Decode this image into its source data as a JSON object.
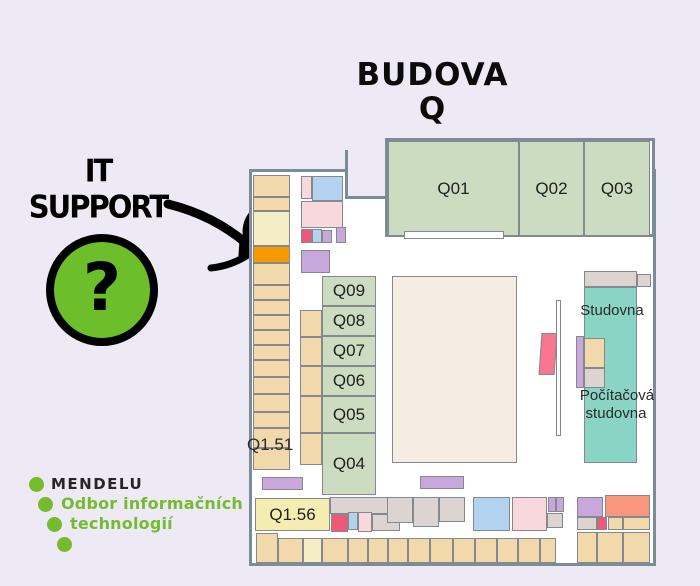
{
  "background": "#EDEAF6",
  "title": {
    "line1": "BUDOVA",
    "line2": "Q"
  },
  "callout": {
    "line1": "IT",
    "line2": "SUPPORT"
  },
  "badge": {
    "symbol": "?",
    "fill": "#6CBE2B"
  },
  "logo": {
    "brand": "MENDELU",
    "dept_line1": "Odbor informačních",
    "dept_line2": "technologií",
    "green": "#74BB2D",
    "brand_color": "#262626"
  },
  "map": {
    "outline_color": "#7c8b95",
    "room_border": "#85898e",
    "colors": {
      "tan": "#F1D9AB",
      "cream": "#F3EEC5",
      "yellow": "#F5ECB2",
      "orange": "#F79A02",
      "green": "#CBDCC1",
      "beige": "#F5EDE1",
      "teal": "#8AD4C6",
      "purple": "#C8A7DD",
      "blue": "#B3D2F0",
      "pink": "#F8D7DD",
      "red": "#EF5878",
      "magenta": "#F8768F",
      "salmon": "#F8977B",
      "gray": "#DBD4D1",
      "white": "#FFFFFF"
    },
    "rooms": [
      {
        "x": 388,
        "y": 141,
        "w": 131,
        "h": 95,
        "c": "green",
        "t": "Q01",
        "i": "room-q01"
      },
      {
        "x": 519,
        "y": 141,
        "w": 65,
        "h": 95,
        "c": "green",
        "t": "Q02",
        "i": "room-q02"
      },
      {
        "x": 584,
        "y": 141,
        "w": 66,
        "h": 95,
        "c": "green",
        "t": "Q03",
        "i": "room-q03"
      },
      {
        "x": 404,
        "y": 231,
        "w": 100,
        "h": 8,
        "c": "white"
      },
      {
        "x": 253,
        "y": 175,
        "w": 37,
        "h": 22,
        "c": "tan"
      },
      {
        "x": 253,
        "y": 197,
        "w": 37,
        "h": 14,
        "c": "tan"
      },
      {
        "x": 253,
        "y": 211,
        "w": 37,
        "h": 35,
        "c": "cream"
      },
      {
        "x": 253,
        "y": 246,
        "w": 37,
        "h": 17,
        "c": "orange",
        "i": "it-support-room"
      },
      {
        "x": 253,
        "y": 263,
        "w": 37,
        "h": 22,
        "c": "tan"
      },
      {
        "x": 253,
        "y": 285,
        "w": 37,
        "h": 15,
        "c": "tan"
      },
      {
        "x": 253,
        "y": 300,
        "w": 37,
        "h": 15,
        "c": "tan"
      },
      {
        "x": 253,
        "y": 315,
        "w": 37,
        "h": 15,
        "c": "tan"
      },
      {
        "x": 253,
        "y": 330,
        "w": 37,
        "h": 15,
        "c": "tan"
      },
      {
        "x": 253,
        "y": 345,
        "w": 37,
        "h": 15,
        "c": "tan"
      },
      {
        "x": 253,
        "y": 360,
        "w": 37,
        "h": 17,
        "c": "tan"
      },
      {
        "x": 253,
        "y": 377,
        "w": 37,
        "h": 17,
        "c": "tan"
      },
      {
        "x": 253,
        "y": 394,
        "w": 37,
        "h": 18,
        "c": "tan"
      },
      {
        "x": 253,
        "y": 412,
        "w": 37,
        "h": 16,
        "c": "tan"
      },
      {
        "x": 253,
        "y": 428,
        "w": 37,
        "h": 20,
        "c": "tan"
      },
      {
        "x": 253,
        "y": 448,
        "w": 37,
        "h": 22,
        "c": "tan"
      },
      {
        "x": 300,
        "y": 310,
        "w": 22,
        "h": 27,
        "c": "tan"
      },
      {
        "x": 300,
        "y": 337,
        "w": 22,
        "h": 29,
        "c": "tan"
      },
      {
        "x": 300,
        "y": 366,
        "w": 22,
        "h": 30,
        "c": "tan"
      },
      {
        "x": 300,
        "y": 396,
        "w": 22,
        "h": 37,
        "c": "tan"
      },
      {
        "x": 300,
        "y": 433,
        "w": 22,
        "h": 32,
        "c": "tan"
      },
      {
        "x": 301,
        "y": 176,
        "w": 11,
        "h": 23,
        "c": "pink"
      },
      {
        "x": 312,
        "y": 176,
        "w": 31,
        "h": 25,
        "c": "blue"
      },
      {
        "x": 301,
        "y": 201,
        "w": 42,
        "h": 27,
        "c": "pink"
      },
      {
        "x": 301,
        "y": 229,
        "w": 11,
        "h": 14,
        "c": "red"
      },
      {
        "x": 312,
        "y": 229,
        "w": 10,
        "h": 14,
        "c": "blue"
      },
      {
        "x": 322,
        "y": 230,
        "w": 10,
        "h": 13,
        "c": "purple"
      },
      {
        "x": 336,
        "y": 227,
        "w": 10,
        "h": 16,
        "c": "purple"
      },
      {
        "x": 301,
        "y": 250,
        "w": 29,
        "h": 23,
        "c": "purple"
      },
      {
        "x": 322,
        "y": 276,
        "w": 54,
        "h": 30,
        "c": "green",
        "t": "Q09",
        "i": "room-q09"
      },
      {
        "x": 322,
        "y": 306,
        "w": 54,
        "h": 30,
        "c": "green",
        "t": "Q08",
        "i": "room-q08"
      },
      {
        "x": 322,
        "y": 336,
        "w": 54,
        "h": 30,
        "c": "green",
        "t": "Q07",
        "i": "room-q07"
      },
      {
        "x": 322,
        "y": 366,
        "w": 54,
        "h": 30,
        "c": "green",
        "t": "Q06",
        "i": "room-q06"
      },
      {
        "x": 322,
        "y": 396,
        "w": 54,
        "h": 37,
        "c": "green",
        "t": "Q05",
        "i": "room-q05"
      },
      {
        "x": 322,
        "y": 433,
        "w": 54,
        "h": 62,
        "c": "green",
        "t": "Q04",
        "i": "room-q04"
      },
      {
        "x": 392,
        "y": 276,
        "w": 125,
        "h": 187,
        "c": "beige",
        "i": "central-hall"
      },
      {
        "x": 584,
        "y": 271,
        "w": 53,
        "h": 16,
        "c": "gray"
      },
      {
        "x": 637,
        "y": 274,
        "w": 14,
        "h": 13,
        "c": "gray"
      },
      {
        "x": 584,
        "y": 287,
        "w": 53,
        "h": 176,
        "c": "teal",
        "i": "studovna-room"
      },
      {
        "x": 576,
        "y": 336,
        "w": 8,
        "h": 52,
        "c": "purple"
      },
      {
        "x": 584,
        "y": 338,
        "w": 21,
        "h": 30,
        "c": "tan"
      },
      {
        "x": 584,
        "y": 368,
        "w": 21,
        "h": 20,
        "c": "gray"
      },
      {
        "x": 540,
        "y": 333,
        "w": 16,
        "h": 42,
        "c": "magenta"
      },
      {
        "x": 556,
        "y": 300,
        "w": 5,
        "h": 136,
        "c": "white",
        "i": "partition-wall"
      },
      {
        "x": 262,
        "y": 477,
        "w": 41,
        "h": 13,
        "c": "purple"
      },
      {
        "x": 420,
        "y": 476,
        "w": 44,
        "h": 13,
        "c": "purple"
      },
      {
        "x": 255,
        "y": 498,
        "w": 75,
        "h": 33,
        "c": "yellow",
        "t": "Q1.56",
        "i": "room-q1-56"
      },
      {
        "x": 330,
        "y": 497,
        "w": 70,
        "h": 17,
        "c": "gray"
      },
      {
        "x": 331,
        "y": 514,
        "w": 17,
        "h": 18,
        "c": "red"
      },
      {
        "x": 348,
        "y": 512,
        "w": 10,
        "h": 18,
        "c": "blue"
      },
      {
        "x": 358,
        "y": 512,
        "w": 14,
        "h": 20,
        "c": "pink"
      },
      {
        "x": 372,
        "y": 514,
        "w": 28,
        "h": 17,
        "c": "gray"
      },
      {
        "x": 387,
        "y": 497,
        "w": 26,
        "h": 26,
        "c": "gray"
      },
      {
        "x": 413,
        "y": 497,
        "w": 26,
        "h": 30,
        "c": "gray"
      },
      {
        "x": 439,
        "y": 497,
        "w": 26,
        "h": 25,
        "c": "gray"
      },
      {
        "x": 473,
        "y": 497,
        "w": 37,
        "h": 34,
        "c": "blue"
      },
      {
        "x": 512,
        "y": 497,
        "w": 35,
        "h": 34,
        "c": "pink"
      },
      {
        "x": 548,
        "y": 497,
        "w": 8,
        "h": 15,
        "c": "purple"
      },
      {
        "x": 556,
        "y": 497,
        "w": 8,
        "h": 15,
        "c": "purple"
      },
      {
        "x": 547,
        "y": 513,
        "w": 16,
        "h": 15,
        "c": "gray"
      },
      {
        "x": 577,
        "y": 497,
        "w": 26,
        "h": 20,
        "c": "purple"
      },
      {
        "x": 605,
        "y": 495,
        "w": 45,
        "h": 22,
        "c": "salmon"
      },
      {
        "x": 577,
        "y": 517,
        "w": 20,
        "h": 13,
        "c": "gray"
      },
      {
        "x": 597,
        "y": 517,
        "w": 10,
        "h": 13,
        "c": "red"
      },
      {
        "x": 608,
        "y": 517,
        "w": 15,
        "h": 13,
        "c": "tan"
      },
      {
        "x": 623,
        "y": 517,
        "w": 27,
        "h": 13,
        "c": "tan"
      },
      {
        "x": 256,
        "y": 533,
        "w": 22,
        "h": 30,
        "c": "tan"
      },
      {
        "x": 278,
        "y": 538,
        "w": 25,
        "h": 25,
        "c": "tan"
      },
      {
        "x": 303,
        "y": 538,
        "w": 19,
        "h": 25,
        "c": "cream"
      },
      {
        "x": 322,
        "y": 538,
        "w": 26,
        "h": 25,
        "c": "tan"
      },
      {
        "x": 348,
        "y": 538,
        "w": 20,
        "h": 25,
        "c": "tan"
      },
      {
        "x": 368,
        "y": 538,
        "w": 20,
        "h": 25,
        "c": "tan"
      },
      {
        "x": 388,
        "y": 538,
        "w": 20,
        "h": 25,
        "c": "tan"
      },
      {
        "x": 408,
        "y": 538,
        "w": 22,
        "h": 25,
        "c": "tan"
      },
      {
        "x": 430,
        "y": 538,
        "w": 23,
        "h": 25,
        "c": "tan"
      },
      {
        "x": 453,
        "y": 538,
        "w": 22,
        "h": 25,
        "c": "tan"
      },
      {
        "x": 475,
        "y": 538,
        "w": 22,
        "h": 25,
        "c": "tan"
      },
      {
        "x": 497,
        "y": 538,
        "w": 21,
        "h": 25,
        "c": "tan"
      },
      {
        "x": 518,
        "y": 538,
        "w": 22,
        "h": 25,
        "c": "tan"
      },
      {
        "x": 540,
        "y": 538,
        "w": 16,
        "h": 25,
        "c": "tan"
      },
      {
        "x": 577,
        "y": 532,
        "w": 20,
        "h": 31,
        "c": "tan"
      },
      {
        "x": 597,
        "y": 532,
        "w": 26,
        "h": 31,
        "c": "tan"
      },
      {
        "x": 623,
        "y": 532,
        "w": 27,
        "h": 31,
        "c": "tan"
      }
    ],
    "labels": [
      {
        "text": "Q1.51",
        "x": 247,
        "y": 436,
        "align": "left",
        "size": 17,
        "i": "label-q1-51"
      },
      {
        "text": "Studovna",
        "x": 612,
        "y": 303,
        "align": "center",
        "size": 15,
        "i": "label-studovna"
      },
      {
        "text": "Počítačová",
        "x": 617,
        "y": 388,
        "align": "center",
        "size": 15,
        "i": "label-pocitacova"
      },
      {
        "text": "studovna",
        "x": 616,
        "y": 406,
        "align": "center",
        "size": 15,
        "i": "label-pocitacova-2"
      }
    ]
  }
}
